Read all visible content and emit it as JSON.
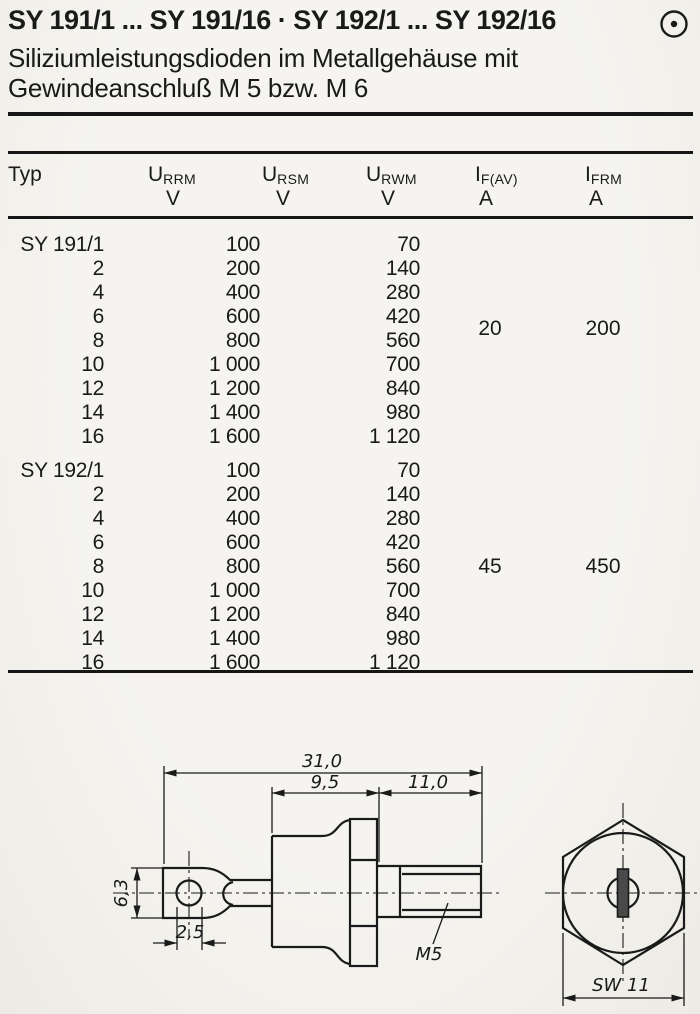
{
  "page": {
    "title": "SY 191/1 ... SY 191/16 · SY 192/1 ... SY 192/16",
    "corner_symbol": "circle-dot",
    "subtitle_line1": "Siliziumleistungsdioden im Metallgehäuse mit",
    "subtitle_line2": "Gewindeanschluß M 5 bzw. M 6"
  },
  "table": {
    "columns": [
      {
        "name": "Typ",
        "sub": "",
        "unit": ""
      },
      {
        "name": "U",
        "sub": "RRM",
        "unit": "V"
      },
      {
        "name": "U",
        "sub": "RSM",
        "unit": "V"
      },
      {
        "name": "U",
        "sub": "RWM",
        "unit": "V"
      },
      {
        "name": "I",
        "sub": "F(AV)",
        "unit": "A"
      },
      {
        "name": "I",
        "sub": "FRM",
        "unit": "A"
      }
    ],
    "sections": [
      {
        "series": "SY 191",
        "rows": [
          {
            "typ": "SY 191/1",
            "urrm": "100",
            "urwm": "70"
          },
          {
            "typ": "2",
            "urrm": "200",
            "urwm": "140"
          },
          {
            "typ": "4",
            "urrm": "400",
            "urwm": "280"
          },
          {
            "typ": "6",
            "urrm": "600",
            "urwm": "420"
          },
          {
            "typ": "8",
            "urrm": "800",
            "urwm": "560"
          },
          {
            "typ": "10",
            "urrm": "1 000",
            "urwm": "700"
          },
          {
            "typ": "12",
            "urrm": "1 200",
            "urwm": "840"
          },
          {
            "typ": "14",
            "urrm": "1 400",
            "urwm": "980"
          },
          {
            "typ": "16",
            "urrm": "1 600",
            "urwm": "1 120"
          }
        ],
        "if_av": "20",
        "ifrm": "200"
      },
      {
        "series": "SY 192",
        "rows": [
          {
            "typ": "SY 192/1",
            "urrm": "100",
            "urwm": "70"
          },
          {
            "typ": "2",
            "urrm": "200",
            "urwm": "140"
          },
          {
            "typ": "4",
            "urrm": "400",
            "urwm": "280"
          },
          {
            "typ": "6",
            "urrm": "600",
            "urwm": "420"
          },
          {
            "typ": "8",
            "urrm": "800",
            "urwm": "560"
          },
          {
            "typ": "10",
            "urrm": "1 000",
            "urwm": "700"
          },
          {
            "typ": "12",
            "urrm": "1 200",
            "urwm": "840"
          },
          {
            "typ": "14",
            "urrm": "1 400",
            "urwm": "980"
          },
          {
            "typ": "16",
            "urrm": "1 600",
            "urwm": "1 120"
          }
        ],
        "if_av": "45",
        "ifrm": "450"
      }
    ]
  },
  "drawing": {
    "labels": {
      "overall_length": "31,0",
      "body_length": "9,5",
      "stud_length": "11,0",
      "lug_height": "6,3",
      "hole_diameter": "2,5",
      "thread": "M5",
      "wrench_size": "SW 11"
    }
  }
}
